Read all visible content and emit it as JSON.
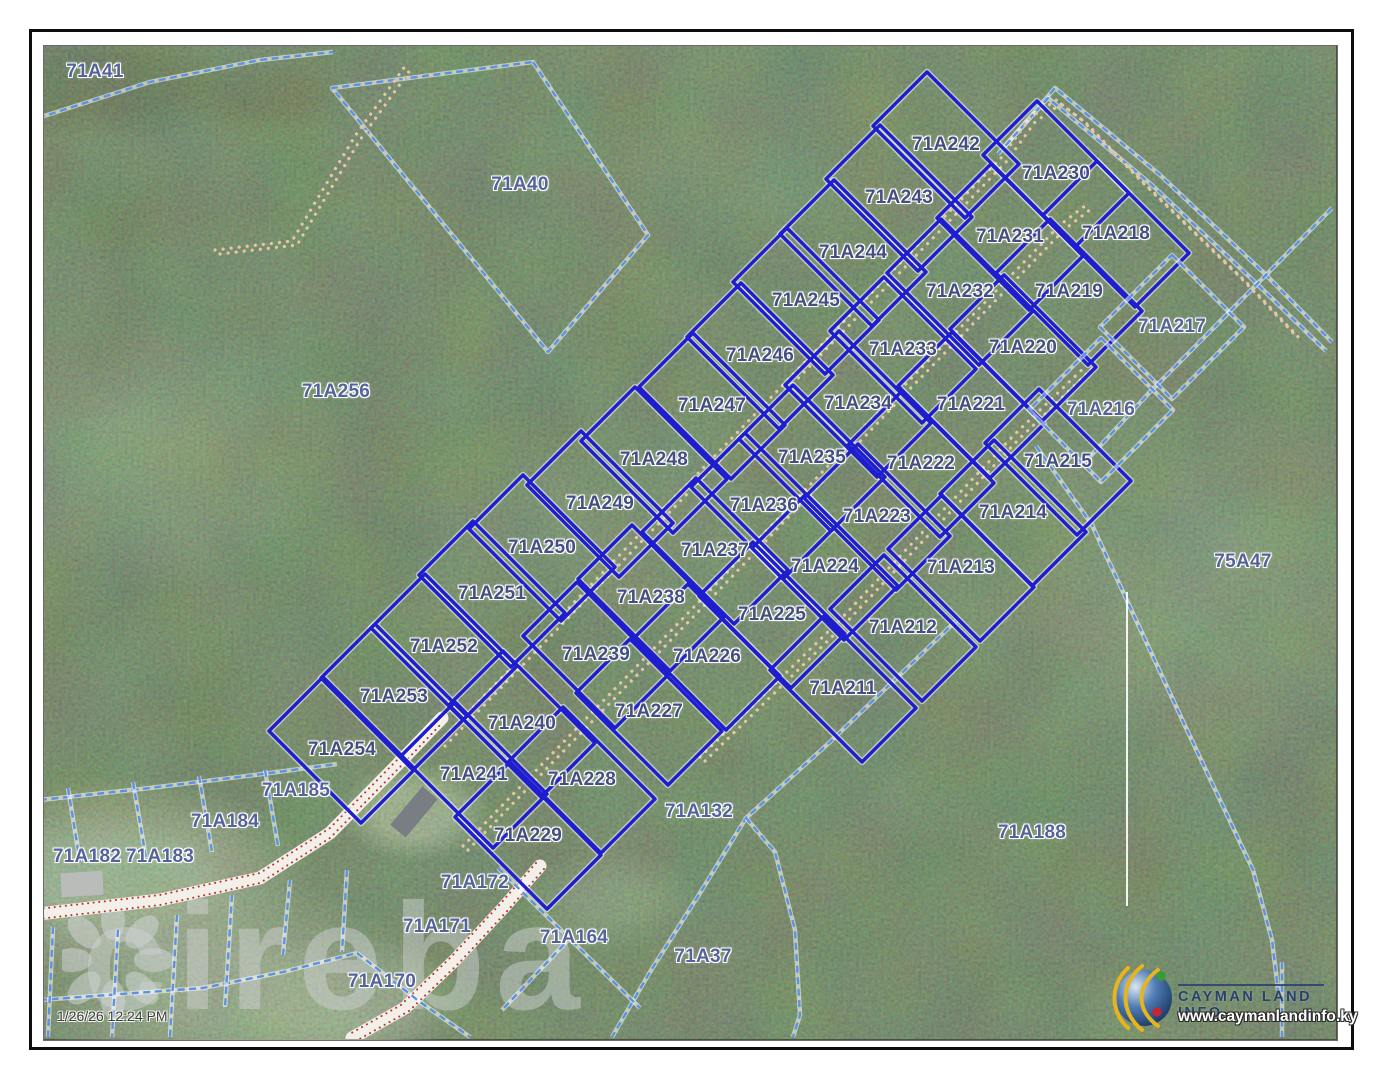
{
  "page": {
    "timestamp": "1/26/26 12:24 PM",
    "watermark": "cireba"
  },
  "branding": {
    "name": "CAYMAN LAND INFO",
    "website": "www.caymanlandinfo.ky"
  },
  "colors": {
    "lot_line": "#1e1ecf",
    "lot_halo": "#ffffff",
    "cadastral_dashed": "#5d92e2",
    "road_dots": "#e5c6a8",
    "road_surface": "#f3f0e9",
    "road_edge_dots": "#c03030",
    "survey_line_white": "#ffffff",
    "lot_label": "#454e80",
    "area_label": "#56639a"
  },
  "map": {
    "lots": [
      {
        "label": "71A242",
        "x": 946,
        "y": 145
      },
      {
        "label": "71A243",
        "x": 899,
        "y": 198
      },
      {
        "label": "71A244",
        "x": 853,
        "y": 253
      },
      {
        "label": "71A245",
        "x": 806,
        "y": 301
      },
      {
        "label": "71A246",
        "x": 760,
        "y": 356
      },
      {
        "label": "71A247",
        "x": 712,
        "y": 406
      },
      {
        "label": "71A248",
        "x": 654,
        "y": 460
      },
      {
        "label": "71A249",
        "x": 600,
        "y": 504
      },
      {
        "label": "71A250",
        "x": 542,
        "y": 548
      },
      {
        "label": "71A251",
        "x": 492,
        "y": 594
      },
      {
        "label": "71A252",
        "x": 444,
        "y": 647
      },
      {
        "label": "71A253",
        "x": 394,
        "y": 697
      },
      {
        "label": "71A254",
        "x": 342,
        "y": 750
      },
      {
        "label": "71A230",
        "x": 1056,
        "y": 174
      },
      {
        "label": "71A231",
        "x": 1010,
        "y": 237
      },
      {
        "label": "71A232",
        "x": 960,
        "y": 292
      },
      {
        "label": "71A233",
        "x": 903,
        "y": 350
      },
      {
        "label": "71A234",
        "x": 858,
        "y": 404
      },
      {
        "label": "71A235",
        "x": 812,
        "y": 458
      },
      {
        "label": "71A236",
        "x": 764,
        "y": 506
      },
      {
        "label": "71A237",
        "x": 715,
        "y": 551
      },
      {
        "label": "71A238",
        "x": 651,
        "y": 598
      },
      {
        "label": "71A239",
        "x": 596,
        "y": 655
      },
      {
        "label": "71A240",
        "x": 522,
        "y": 724
      },
      {
        "label": "71A241",
        "x": 474,
        "y": 775
      },
      {
        "label": "71A218",
        "x": 1116,
        "y": 234
      },
      {
        "label": "71A219",
        "x": 1069,
        "y": 292
      },
      {
        "label": "71A220",
        "x": 1023,
        "y": 348
      },
      {
        "label": "71A221",
        "x": 971,
        "y": 405
      },
      {
        "label": "71A222",
        "x": 921,
        "y": 464
      },
      {
        "label": "71A223",
        "x": 877,
        "y": 517
      },
      {
        "label": "71A224",
        "x": 825,
        "y": 567
      },
      {
        "label": "71A225",
        "x": 772,
        "y": 615
      },
      {
        "label": "71A226",
        "x": 707,
        "y": 657
      },
      {
        "label": "71A227",
        "x": 649,
        "y": 712
      },
      {
        "label": "71A228",
        "x": 582,
        "y": 780
      },
      {
        "label": "71A229",
        "x": 528,
        "y": 836
      },
      {
        "label": "71A215",
        "x": 1058,
        "y": 462
      },
      {
        "label": "71A214",
        "x": 1013,
        "y": 513
      },
      {
        "label": "71A213",
        "x": 961,
        "y": 568
      },
      {
        "label": "71A212",
        "x": 903,
        "y": 628
      },
      {
        "label": "71A211",
        "x": 843,
        "y": 689
      }
    ],
    "areas": [
      {
        "label": "71A41",
        "x": 95,
        "y": 72
      },
      {
        "label": "71A40",
        "x": 520,
        "y": 185
      },
      {
        "label": "71A256",
        "x": 336,
        "y": 392
      },
      {
        "label": "71A217",
        "x": 1172,
        "y": 327,
        "outline": true
      },
      {
        "label": "71A216",
        "x": 1101,
        "y": 410,
        "outline": true
      },
      {
        "label": "75A47",
        "x": 1243,
        "y": 562
      },
      {
        "label": "71A185",
        "x": 296,
        "y": 791
      },
      {
        "label": "71A184",
        "x": 225,
        "y": 822
      },
      {
        "label": "71A183",
        "x": 160,
        "y": 857
      },
      {
        "label": "71A182",
        "x": 87,
        "y": 857
      },
      {
        "label": "71A132",
        "x": 699,
        "y": 812
      },
      {
        "label": "71A188",
        "x": 1032,
        "y": 833
      },
      {
        "label": "71A172",
        "x": 475,
        "y": 883
      },
      {
        "label": "71A171",
        "x": 437,
        "y": 927
      },
      {
        "label": "71A164",
        "x": 574,
        "y": 938
      },
      {
        "label": "71A170",
        "x": 382,
        "y": 982
      },
      {
        "label": "71A37",
        "x": 703,
        "y": 957
      }
    ],
    "dashed_boundaries": [
      {
        "pts": [
          [
            38,
            118
          ],
          [
            150,
            82
          ],
          [
            260,
            60
          ],
          [
            333,
            52
          ]
        ]
      },
      {
        "pts": [
          [
            533,
            62
          ],
          [
            648,
            235
          ],
          [
            548,
            352
          ],
          [
            332,
            88
          ]
        ],
        "closed": true
      },
      {
        "pts": [
          [
            1005,
            146
          ],
          [
            1055,
            88
          ],
          [
            1160,
            175
          ],
          [
            1263,
            272
          ],
          [
            1332,
            342
          ]
        ]
      },
      {
        "pts": [
          [
            998,
            154
          ],
          [
            1048,
            98
          ],
          [
            1153,
            186
          ],
          [
            1256,
            283
          ],
          [
            1326,
            351
          ]
        ]
      },
      {
        "pts": [
          [
            1332,
            208
          ],
          [
            1263,
            278
          ],
          [
            1150,
            392
          ],
          [
            1087,
            460
          ]
        ]
      },
      {
        "pts": [
          [
            1036,
            446
          ],
          [
            1092,
            525
          ],
          [
            1187,
            730
          ],
          [
            1253,
            870
          ],
          [
            1272,
            940
          ],
          [
            1278,
            990
          ]
        ]
      },
      {
        "pts": [
          [
            957,
            620
          ],
          [
            830,
            742
          ],
          [
            746,
            818
          ],
          [
            700,
            893
          ],
          [
            650,
            972
          ],
          [
            612,
            1037
          ]
        ]
      },
      {
        "pts": [
          [
            746,
            818
          ],
          [
            775,
            852
          ],
          [
            795,
            930
          ],
          [
            800,
            1015
          ],
          [
            793,
            1037
          ]
        ]
      },
      {
        "pts": [
          [
            40,
            800
          ],
          [
            150,
            788
          ],
          [
            255,
            775
          ],
          [
            337,
            764
          ]
        ]
      },
      {
        "pts": [
          [
            68,
            788
          ],
          [
            80,
            862
          ]
        ]
      },
      {
        "pts": [
          [
            133,
            782
          ],
          [
            146,
            858
          ]
        ]
      },
      {
        "pts": [
          [
            199,
            776
          ],
          [
            212,
            852
          ]
        ]
      },
      {
        "pts": [
          [
            265,
            770
          ],
          [
            278,
            846
          ]
        ]
      },
      {
        "pts": [
          [
            40,
            1000
          ],
          [
            203,
            988
          ],
          [
            283,
            972
          ],
          [
            357,
            953
          ]
        ]
      },
      {
        "pts": [
          [
            53,
            927
          ],
          [
            48,
            1037
          ]
        ]
      },
      {
        "pts": [
          [
            118,
            930
          ],
          [
            112,
            1037
          ]
        ]
      },
      {
        "pts": [
          [
            177,
            915
          ],
          [
            170,
            1037
          ]
        ]
      },
      {
        "pts": [
          [
            232,
            895
          ],
          [
            225,
            1007
          ]
        ]
      },
      {
        "pts": [
          [
            290,
            880
          ],
          [
            283,
            955
          ]
        ]
      },
      {
        "pts": [
          [
            347,
            870
          ],
          [
            342,
            952
          ]
        ]
      },
      {
        "pts": [
          [
            357,
            953
          ],
          [
            420,
            1002
          ],
          [
            470,
            1037
          ]
        ]
      },
      {
        "pts": [
          [
            498,
            868
          ],
          [
            640,
            1008
          ]
        ]
      },
      {
        "pts": [
          [
            572,
            936
          ],
          [
            502,
            1010
          ]
        ]
      },
      {
        "pts": [
          [
            1282,
            962
          ],
          [
            1282,
            1037
          ]
        ]
      }
    ],
    "dotted_roads": [
      {
        "pts": [
          [
            440,
            742
          ],
          [
            1001,
            158
          ],
          [
            1030,
            118
          ],
          [
            1056,
            100
          ],
          [
            1082,
            120
          ],
          [
            1140,
            180
          ],
          [
            1243,
            280
          ],
          [
            1298,
            338
          ]
        ]
      },
      {
        "pts": [
          [
            463,
            846
          ],
          [
            720,
            580
          ],
          [
            900,
            390
          ],
          [
            1060,
            225
          ],
          [
            1086,
            205
          ]
        ]
      },
      {
        "pts": [
          [
            700,
            757
          ],
          [
            838,
            622
          ],
          [
            1014,
            435
          ],
          [
            1090,
            362
          ]
        ]
      },
      {
        "pts": [
          [
            215,
            250
          ],
          [
            292,
            241
          ],
          [
            355,
            136
          ],
          [
            408,
            62
          ]
        ]
      }
    ],
    "white_roads": [
      {
        "pts": [
          [
            38,
            914
          ],
          [
            160,
            900
          ],
          [
            260,
            878
          ],
          [
            330,
            833
          ],
          [
            400,
            762
          ],
          [
            442,
            718
          ]
        ],
        "off": [
          [
            0,
            -5
          ],
          [
            0,
            5
          ]
        ]
      },
      {
        "pts": [
          [
            540,
            866
          ],
          [
            505,
            906
          ],
          [
            455,
            960
          ],
          [
            405,
            1008
          ],
          [
            352,
            1038
          ]
        ],
        "off": [
          [
            -4,
            -3
          ],
          [
            4,
            3
          ]
        ]
      }
    ],
    "white_lines": [
      {
        "pts": [
          [
            1127,
            592
          ],
          [
            1127,
            906
          ]
        ]
      }
    ],
    "buildings": [
      {
        "x": 414,
        "y": 812,
        "w": 50,
        "h": 20,
        "rot": -50,
        "fill": "#787e84"
      },
      {
        "x": 82,
        "y": 884,
        "w": 42,
        "h": 24,
        "rot": -4,
        "fill": "#b9bcb8"
      }
    ]
  }
}
